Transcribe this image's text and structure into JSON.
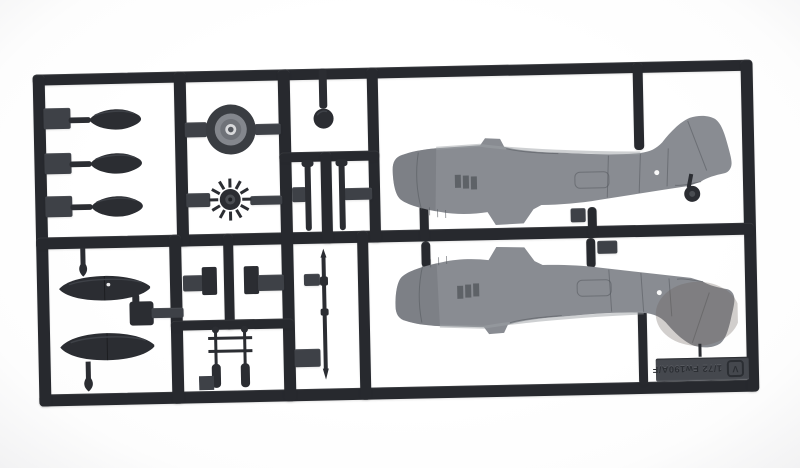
{
  "label_tag": {
    "scale_text": "1/72 Fw190A/F",
    "logo_letter": "V"
  },
  "colors": {
    "background": "#fdfdfd",
    "sprue": "#27292e",
    "sprue_highlight": "#3e4147",
    "part_dark": "#2b2d32",
    "fuselage_gray": "#898c92",
    "fuselage_light": "#9ea1a6",
    "fuselage_dark": "#6f7278",
    "cowl_mid_gray": "#84878d",
    "tail_tint": "#6b6159",
    "label_plate": "#45484e",
    "label_text": "#2b2e33",
    "highlight_dot": "#ffffff"
  },
  "parts": {
    "upper_left_cell": [
      "propeller-blade",
      "propeller-blade",
      "propeller-blade"
    ],
    "upper_middle_cell": [
      "engine-cowling-ring",
      "engine-cooling-fan"
    ],
    "upper_right_cells": [
      "tail-wheel-ball",
      "gear-strut",
      "gear-strut"
    ],
    "fuselage_area": [
      "fuselage-half-starboard",
      "fuselage-half-port",
      "tail-wheel"
    ],
    "lower_left_cell": [
      "gear-leg-pin",
      "drop-tank",
      "bomb-rack",
      "drop-tank",
      "gear-leg-pin"
    ],
    "lower_middle_cells": [
      "flat-panel-part",
      "flat-panel-part",
      "antenna-frame",
      "cannon-barrel-rod"
    ]
  }
}
